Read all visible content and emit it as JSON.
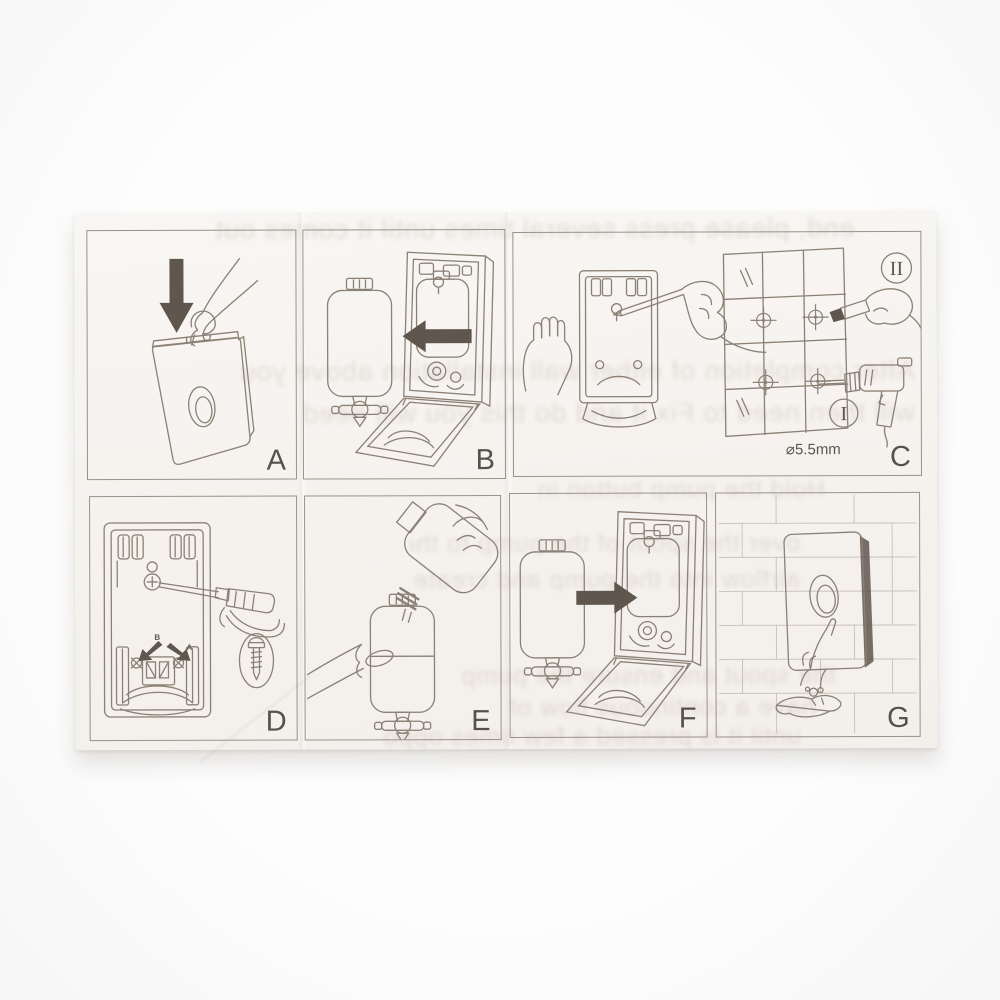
{
  "colors": {
    "background": "#fcfcfc",
    "paper": "#f6f3ef",
    "line_art": "#8b8075",
    "arrow": "#5f574e",
    "panel_border": "#9a9189",
    "label_text": "#57514a",
    "ghost_text": "#cfc5bd",
    "brick_line": "#c7c0b7"
  },
  "panels": [
    {
      "label": "A",
      "scene": "insert-key-and-unlock-top-of-cover"
    },
    {
      "label": "B",
      "scene": "open-cover-and-remove-bottle"
    },
    {
      "label": "C",
      "scene": "hold-back-plate-on-wall-mark-holes-and-drill"
    },
    {
      "label": "D",
      "scene": "fasten-back-plate-with-screws"
    },
    {
      "label": "E",
      "scene": "refill-bottle-with-soap"
    },
    {
      "label": "F",
      "scene": "insert-bottle-back-into-housing"
    },
    {
      "label": "G",
      "scene": "mounted-dispenser-in-use-on-wall"
    }
  ],
  "annotations": {
    "step_mark_numeral": "II",
    "step_drill_numeral": "I",
    "drill_diameter": "⌀5.5mm",
    "screw_arrow_left_letter": "B",
    "screw_arrow_right_letter": "A"
  },
  "bleedthrough_fragments": [
    "end, please press several times until it comes out",
    "After completion of either wall installation above you",
    "will then need to Fix it and do this you will need",
    "Hold the pump button in",
    "over the spout of the pump to the",
    "airflow into the pump and create a slight",
    "the spout and ensure the pump",
    "have a continuous flow of the",
    "until it is pressed a few times oppo"
  ]
}
